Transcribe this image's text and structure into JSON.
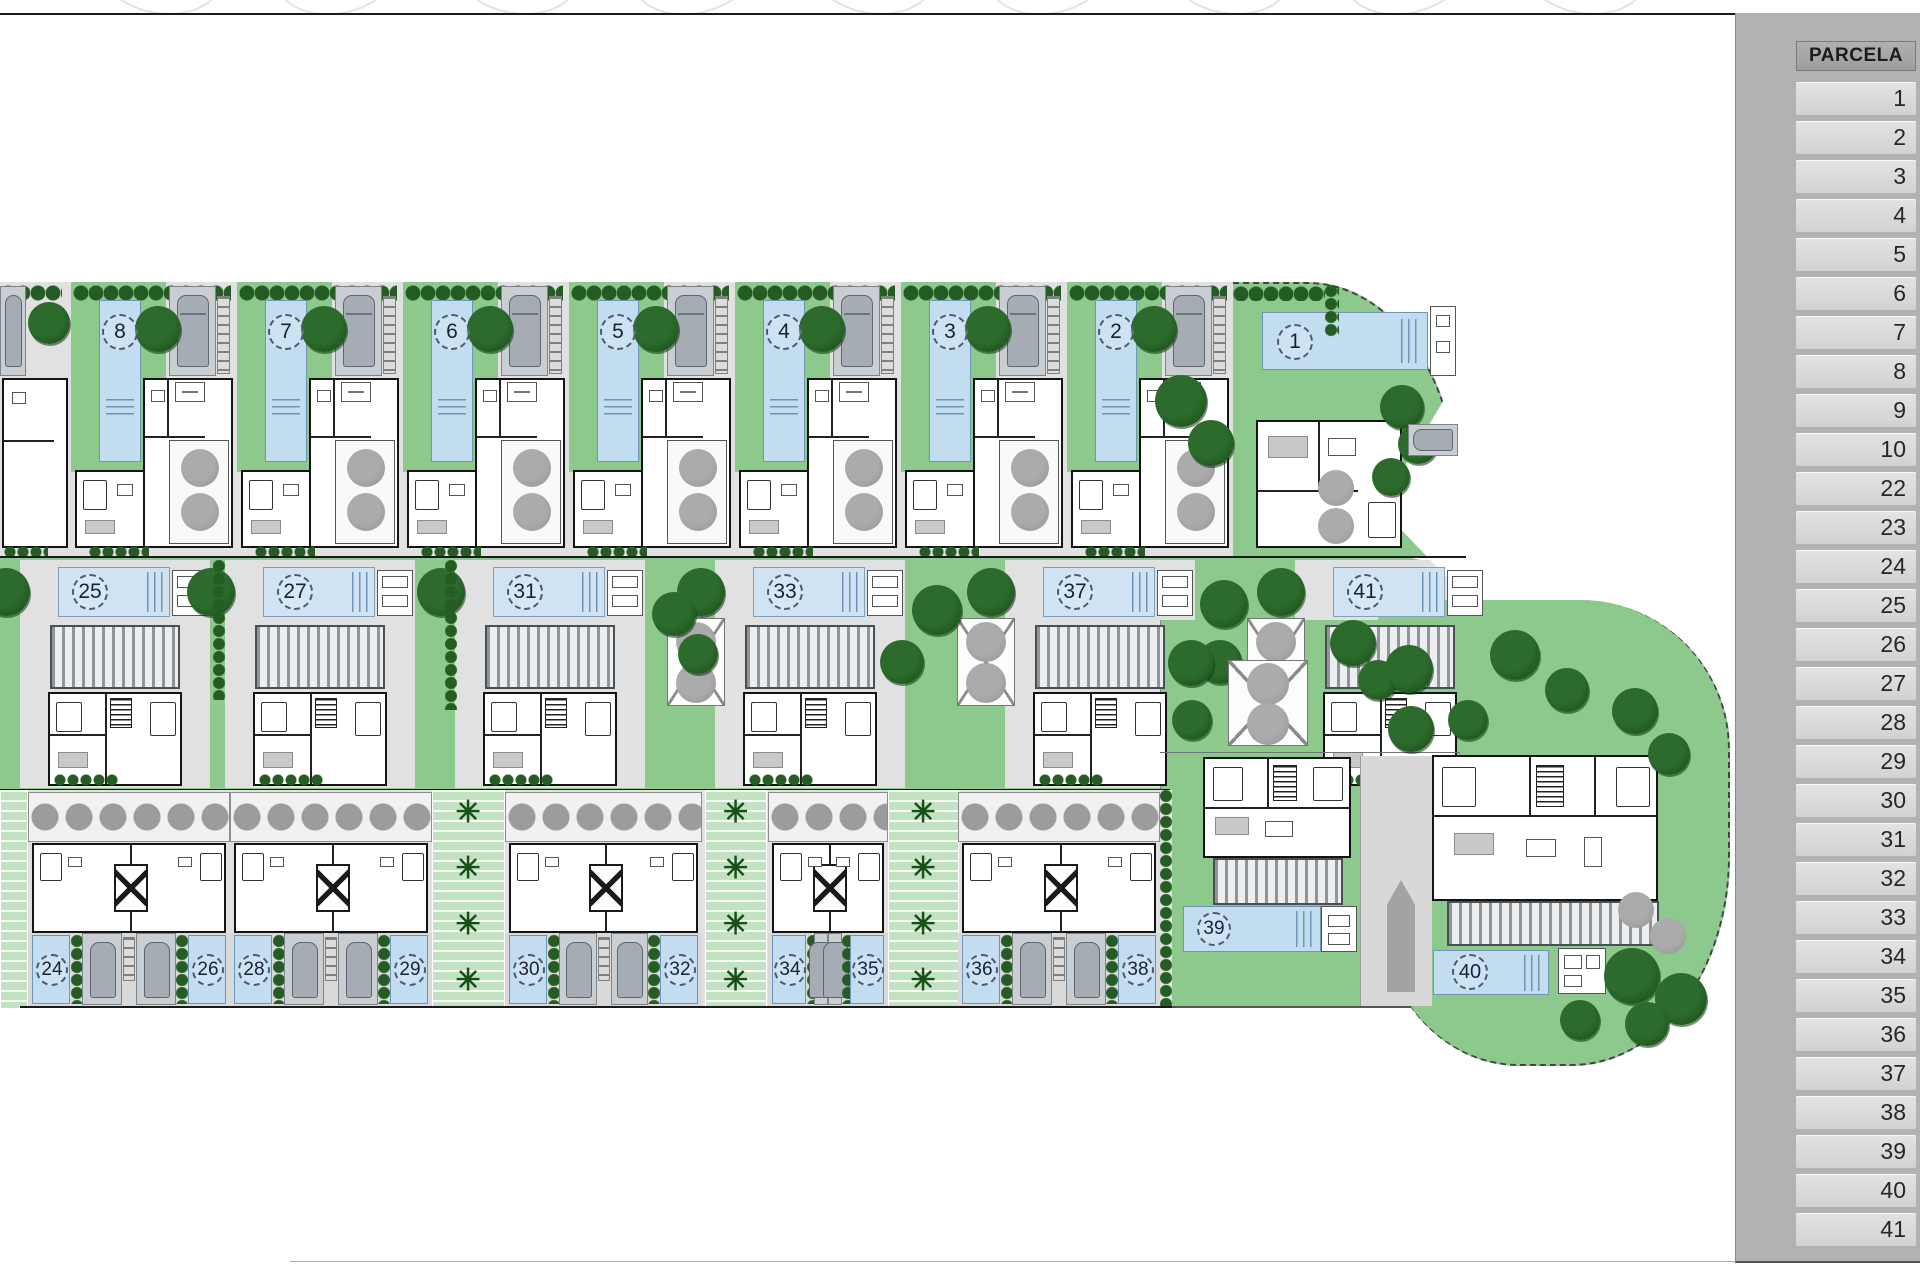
{
  "sheet": {
    "parcela_header": "PARCELA",
    "parcela_rows": [
      "1",
      "2",
      "3",
      "4",
      "5",
      "6",
      "7",
      "8",
      "9",
      "10",
      "22",
      "23",
      "24",
      "25",
      "26",
      "27",
      "28",
      "29",
      "30",
      "31",
      "32",
      "33",
      "34",
      "35",
      "36",
      "37",
      "38",
      "39",
      "40",
      "41"
    ]
  },
  "plan": {
    "top_row_units": [
      "8",
      "7",
      "6",
      "5",
      "4",
      "3",
      "2"
    ],
    "unit_one": "1",
    "middle_row_units": [
      "25",
      "27",
      "31",
      "33",
      "37",
      "41"
    ],
    "bottom_pairs": [
      [
        "24",
        "26"
      ],
      [
        "28",
        "29"
      ],
      [
        "30",
        "32"
      ],
      [
        "34",
        "35"
      ],
      [
        "36",
        "38"
      ]
    ],
    "detached_units": [
      "39",
      "40"
    ]
  },
  "colors": {
    "lawn": "#8dc98d",
    "pool_blue": "#c3ddf0",
    "pool_light": "#cfe3f3",
    "tree_green": "#1e571e",
    "gray_tree": "#9c9c9c",
    "paving": "#e1e1e1",
    "hedge_green": "#245c24",
    "panel_gray": "#b2b2b2",
    "row_gray": "#d9d9d9",
    "number_navy": "#16213c"
  }
}
